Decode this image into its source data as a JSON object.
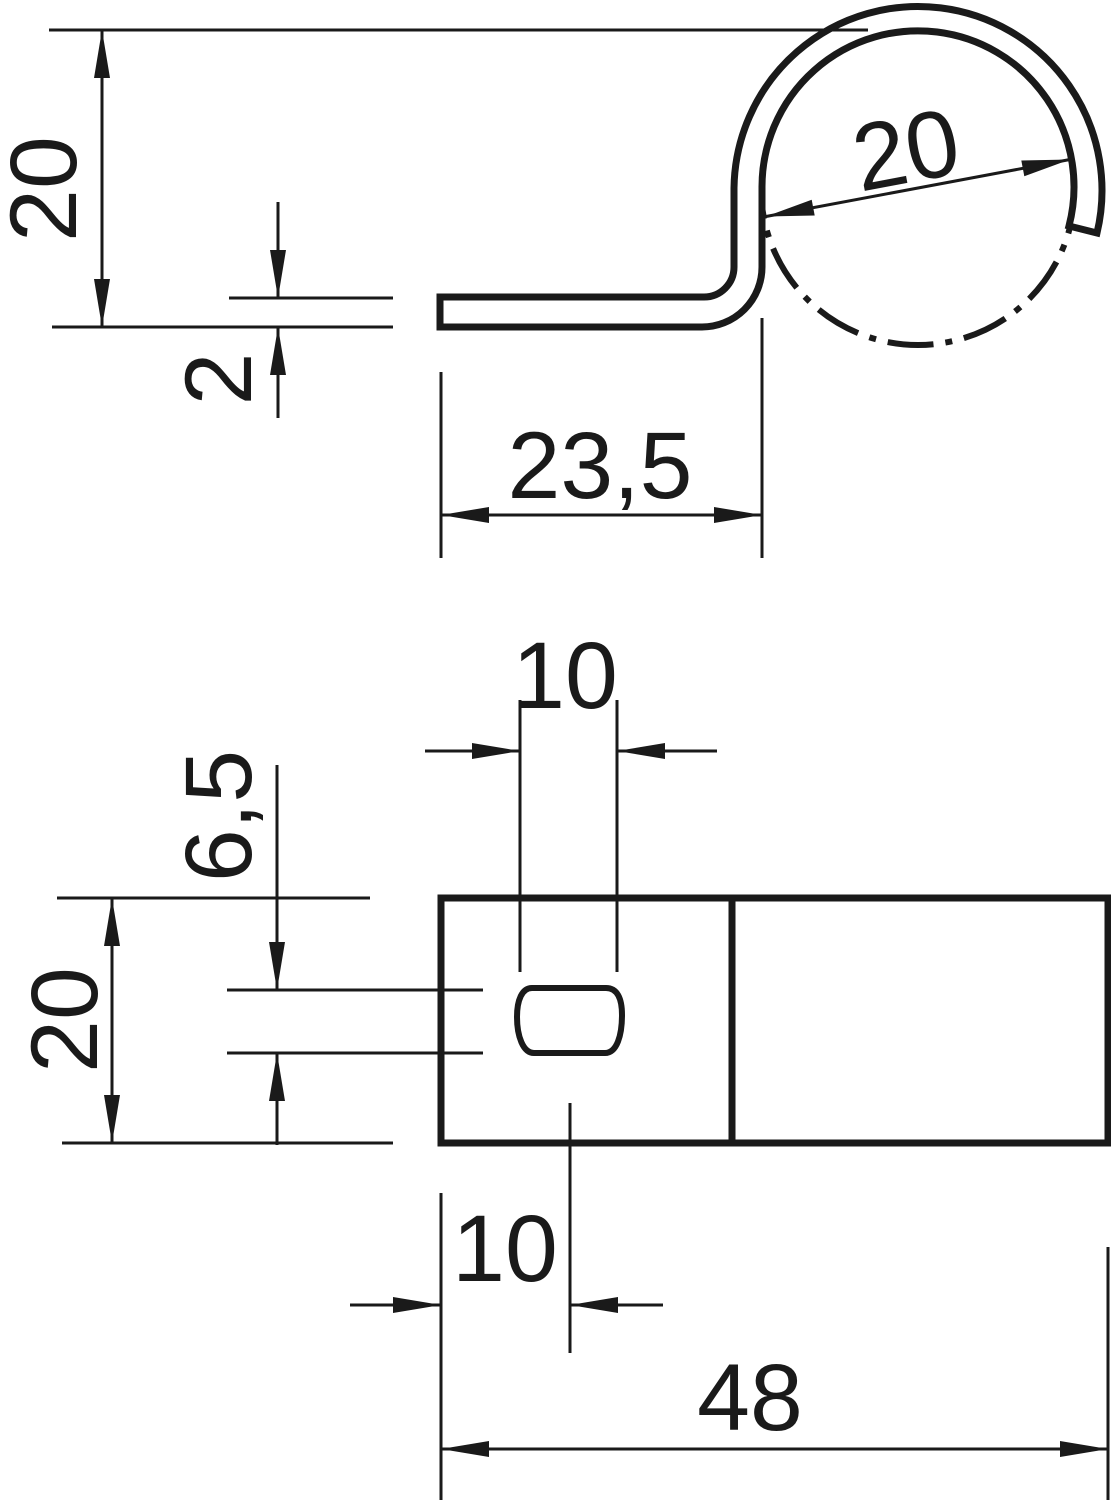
{
  "drawing": {
    "type": "technical-dimension-drawing",
    "line_color": "#1a1a1a",
    "background_color": "#ffffff",
    "side_view": {
      "height_label": "20",
      "thickness_label": "2",
      "foot_length_label": "23,5",
      "clamp_diameter_label": "20"
    },
    "plan_view": {
      "slot_length_label": "10",
      "slot_width_label": "6,5",
      "plate_width_label": "20",
      "slot_offset_label": "10",
      "plate_length_label": "48"
    }
  }
}
